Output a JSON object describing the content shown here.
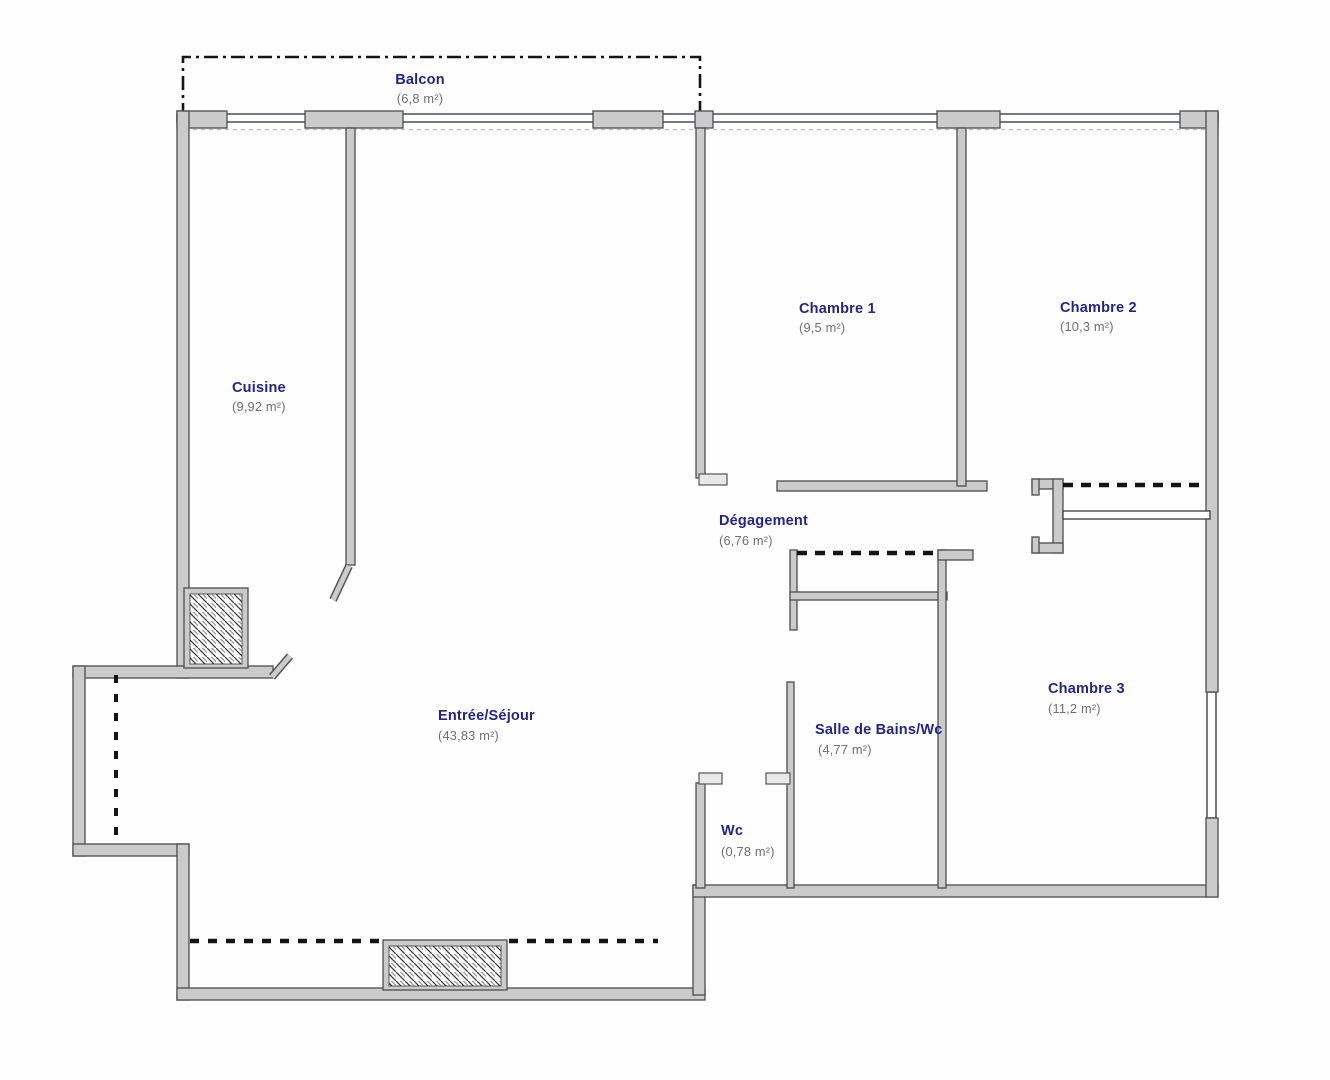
{
  "plan": {
    "type": "apartment-floorplan",
    "rooms": [
      {
        "id": "balcon",
        "name": "Balcon",
        "area": "(6,8 m²)"
      },
      {
        "id": "cuisine",
        "name": "Cuisine",
        "area": "(9,92 m²)"
      },
      {
        "id": "chambre1",
        "name": "Chambre 1",
        "area": "(9,5 m²)"
      },
      {
        "id": "chambre2",
        "name": "Chambre 2",
        "area": "(10,3 m²)"
      },
      {
        "id": "degagement",
        "name": "Dégagement",
        "area": "(6,76 m²)"
      },
      {
        "id": "entree_sejour",
        "name": "Entrée/Séjour",
        "area": "(43,83 m²)"
      },
      {
        "id": "salle_de_bains",
        "name": "Salle de Bains/Wc",
        "area": "(4,77 m²)"
      },
      {
        "id": "wc",
        "name": "Wc",
        "area": "(0,78 m²)"
      },
      {
        "id": "chambre3",
        "name": "Chambre 3",
        "area": "(11,2 m²)"
      }
    ],
    "colors": {
      "room_name": "#23238f",
      "room_area": "#6e6e6e",
      "wall_fill": "#cbcbcb",
      "wall_stroke": "#4d4d4d",
      "window_line": "#3c3c5c",
      "dashed_line": "#151515",
      "background": "#fefefe"
    }
  }
}
